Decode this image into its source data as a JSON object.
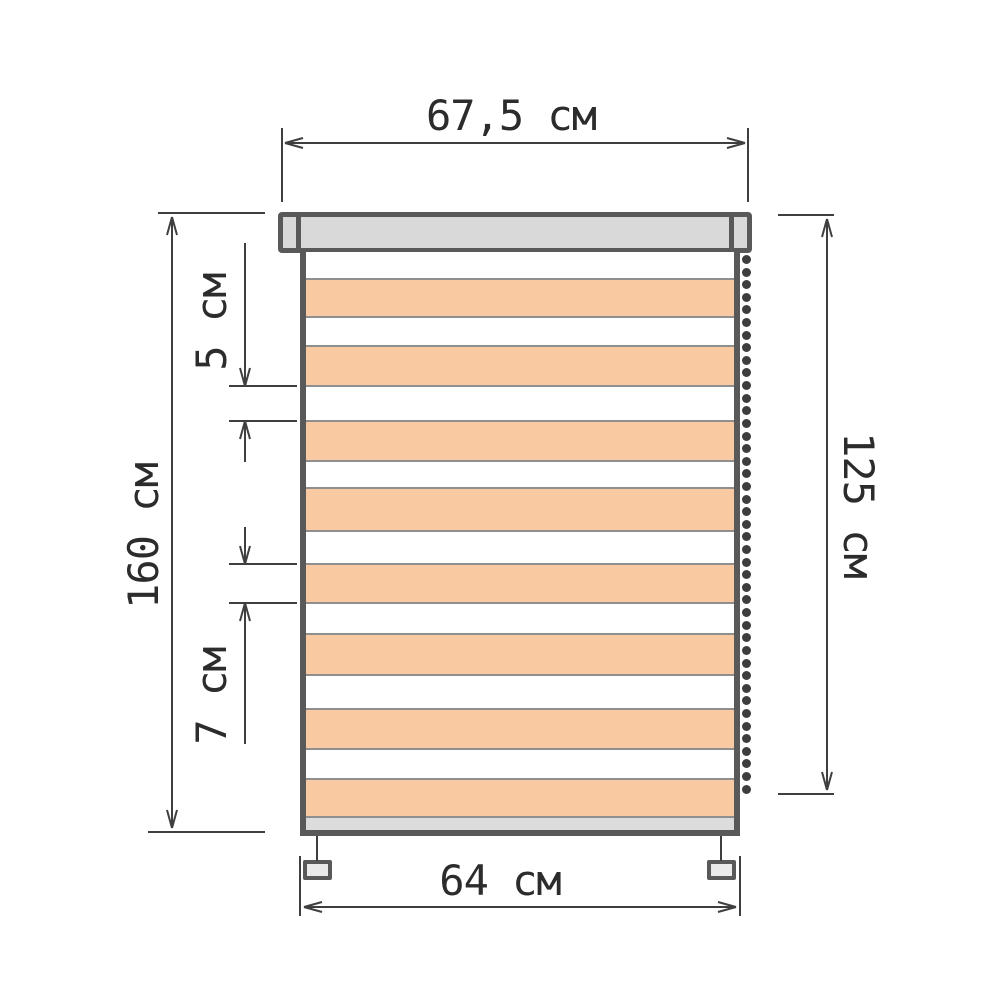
{
  "diagram_type": "roller-blind-dimension-drawing",
  "dimensions": {
    "top_width": "67,5 см",
    "left_height": "160 см",
    "sheer_stripe": "5 см",
    "opaque_stripe": "7 см",
    "right_height": "125 см",
    "bottom_width": "64 см"
  },
  "colors": {
    "outline": "#595959",
    "cassette_fill": "#d9d9d9",
    "stripe_opaque": "#f9c9a2",
    "stripe_sheer": "#ffffff",
    "stripe_divider": "#8f8f8f",
    "dimension": "#3f3f3f",
    "text": "#2c2c2c",
    "chain_bead": "#3d3d3d",
    "rail_fill": "#dcdcdc",
    "bracket_fill": "#eaeaea",
    "background": "#ffffff"
  },
  "blind": {
    "chain_bead_count": 43,
    "stripes": [
      {
        "type": "sheer",
        "height": 26
      },
      {
        "type": "opaque",
        "height": 38
      },
      {
        "type": "sheer",
        "height": 29
      },
      {
        "type": "opaque",
        "height": 40
      },
      {
        "type": "sheer",
        "height": 35
      },
      {
        "type": "opaque",
        "height": 40
      },
      {
        "type": "sheer",
        "height": 27
      },
      {
        "type": "opaque",
        "height": 43
      },
      {
        "type": "sheer",
        "height": 33
      },
      {
        "type": "opaque",
        "height": 39
      },
      {
        "type": "sheer",
        "height": 31
      },
      {
        "type": "opaque",
        "height": 41
      },
      {
        "type": "sheer",
        "height": 34
      },
      {
        "type": "opaque",
        "height": 40
      },
      {
        "type": "sheer",
        "height": 30
      },
      {
        "type": "opaque",
        "height": 38
      }
    ]
  }
}
